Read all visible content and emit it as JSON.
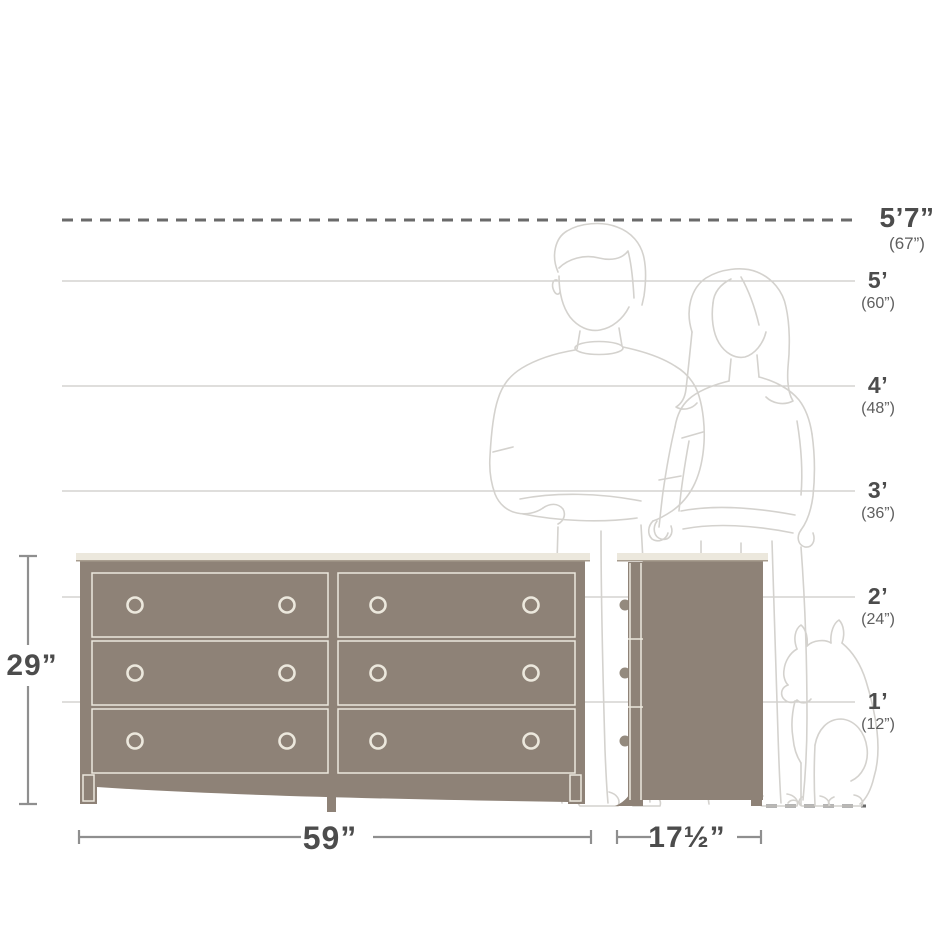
{
  "height_scale": {
    "markers": [
      {
        "id": "5ft7",
        "label": "5’7”",
        "inches": "(67”)"
      },
      {
        "id": "5ft",
        "label": "5’",
        "inches": "(60”)"
      },
      {
        "id": "4ft",
        "label": "4’",
        "inches": "(48”)"
      },
      {
        "id": "3ft",
        "label": "3’",
        "inches": "(36”)"
      },
      {
        "id": "2ft",
        "label": "2’",
        "inches": "(24”)"
      },
      {
        "id": "1ft",
        "label": "1’",
        "inches": "(12”)"
      }
    ]
  },
  "product_dimensions": {
    "height": "29”",
    "width": "59”",
    "depth": "17½”"
  },
  "colors": {
    "furniture_fill": "#8e8277",
    "furniture_trim": "#ece8dd",
    "furniture_shadow": "#a89d8f",
    "knob_side_fill": "#948a7e",
    "figure_outline": "#d4d2ce",
    "gridline": "#ccc9c6",
    "dashed_line": "#6a6a6a",
    "dimension_line": "#8f8f8f",
    "label_primary": "#4c4c4c",
    "label_secondary": "#5e5e5e",
    "background": "#ffffff"
  }
}
